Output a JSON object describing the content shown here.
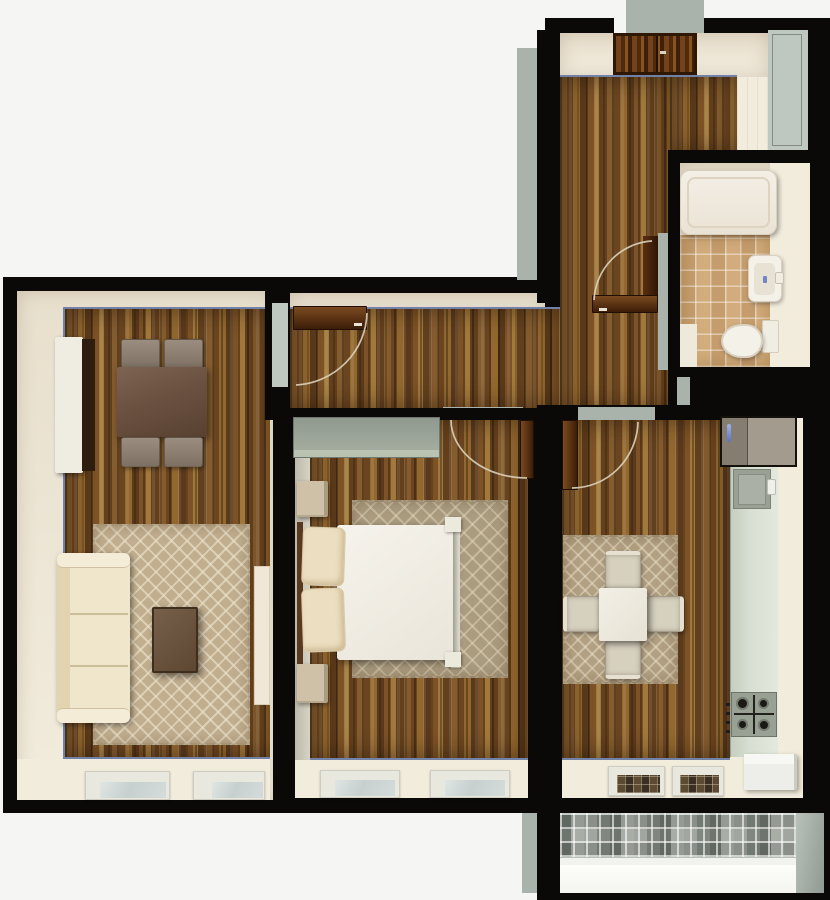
{
  "scene": {
    "title": "apartment-floor-plan-3d-top-view",
    "type": "3d-render",
    "rooms": [
      {
        "name": "living-room",
        "floor": "wood-parquet",
        "items": [
          "tv-stand",
          "dining-table",
          "four-chairs",
          "patterned-rug",
          "coffee-table",
          "sofa",
          "side-cabinet",
          "two-windows"
        ]
      },
      {
        "name": "corridor",
        "floor": "wood-parquet",
        "items": [
          "open-door-to-living-room"
        ]
      },
      {
        "name": "entry-hall",
        "floor": "wood-parquet",
        "items": [
          "entry-door",
          "built-in-closet"
        ]
      },
      {
        "name": "bathroom",
        "floor": "beige-tile",
        "items": [
          "bathtub",
          "washbasin",
          "toilet",
          "bath-mat",
          "open-door"
        ]
      },
      {
        "name": "bedroom",
        "floor": "wood-parquet",
        "items": [
          "wardrobe",
          "double-bed",
          "two-pillows",
          "two-nightstands",
          "patterned-rug",
          "two-windows",
          "open-door"
        ]
      },
      {
        "name": "kitchen",
        "floor": "wood-parquet",
        "items": [
          "refrigerator",
          "sink",
          "counter",
          "gas-stove",
          "dining-table",
          "four-chairs",
          "rug",
          "white-cabinet",
          "two-windows",
          "open-door"
        ]
      },
      {
        "name": "balcony",
        "floor": "mosaic-tile",
        "items": []
      }
    ]
  },
  "palette": {
    "bg": "#f5f5f3",
    "wall": "#0b0907",
    "cream": "#e8dfcd",
    "creamLight": "#f2ecdd",
    "grayFace": "#a9b3ac",
    "grayPanel": "#bfc8c0",
    "edgeBlue": "#7181a8",
    "wood": "#7a5226",
    "tile": "#d2ac7c",
    "rugLiving": "#c1ae8f",
    "rugBedroom": "#ab9c80",
    "rugKitchen": "#b2a083",
    "sofa": "#efe6cb",
    "sofaShade": "#e2d4ae",
    "furnWhite": "#efece1",
    "nightstand": "#cec1a7",
    "tableBrown": "#6b5140",
    "chairCream": "#d6d0bf",
    "doorLight": "#7a4a20",
    "doorDark": "#3c1d08",
    "arc": "#dcd2bd",
    "wardrobe": "#97a196",
    "counter": "#d7dfd2",
    "steel": "#99a194",
    "fridgeLight": "#a39c8e",
    "fridgeDark": "#857d70",
    "led": "#6f86c8",
    "mattress": "#f4f1e9",
    "pillow": "#ecdfc1",
    "glass": "#ccd5d4",
    "frame": "#e9e8df",
    "darkGlass": "#453a2c",
    "mosaic": "#b9bdb7",
    "tub": "#f2ede3"
  }
}
